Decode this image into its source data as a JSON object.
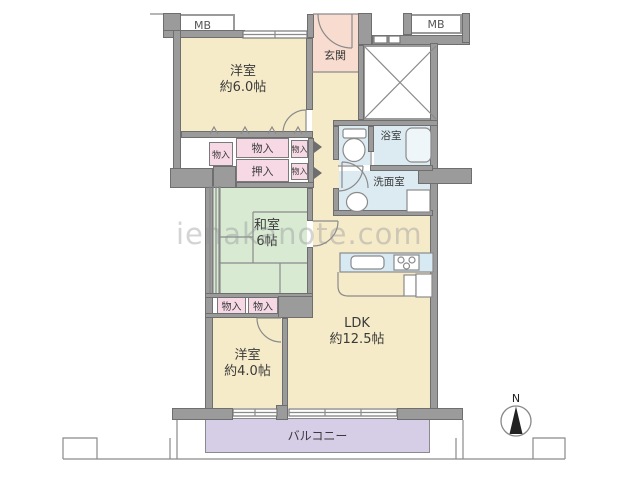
{
  "title": "apartment-floor-plan",
  "watermark": "ienakanote.com",
  "compass": {
    "label": "N"
  },
  "rooms": {
    "mb_left": "MB",
    "mb_right": "MB",
    "genkan": "玄関",
    "yoshitsu1": {
      "name": "洋室",
      "size": "約6.0帖"
    },
    "washitsu": {
      "name": "和室",
      "size": "6帖"
    },
    "yoshitsu2": {
      "name": "洋室",
      "size": "約4.0帖"
    },
    "ldk": {
      "name": "LDK",
      "size": "約12.5帖"
    },
    "bath": "浴室",
    "washroom": "洗面室",
    "balcony": "バルコニー"
  },
  "storage": {
    "left": "物入",
    "top_wide": "物入",
    "top_small": "物入",
    "oshiire": "押入",
    "mid_small": "物入",
    "lower_left": "物入",
    "lower_right": "物入"
  },
  "colors": {
    "room_cream": "#f6ebc9",
    "entrance_pink": "#f8dcd0",
    "storage_pink": "#f7d9e6",
    "tatami_green": "#d8ead2",
    "water_blue": "#dcebf2",
    "balcony_purple": "#d6cde6",
    "wall_gray": "#9b9b9b"
  }
}
